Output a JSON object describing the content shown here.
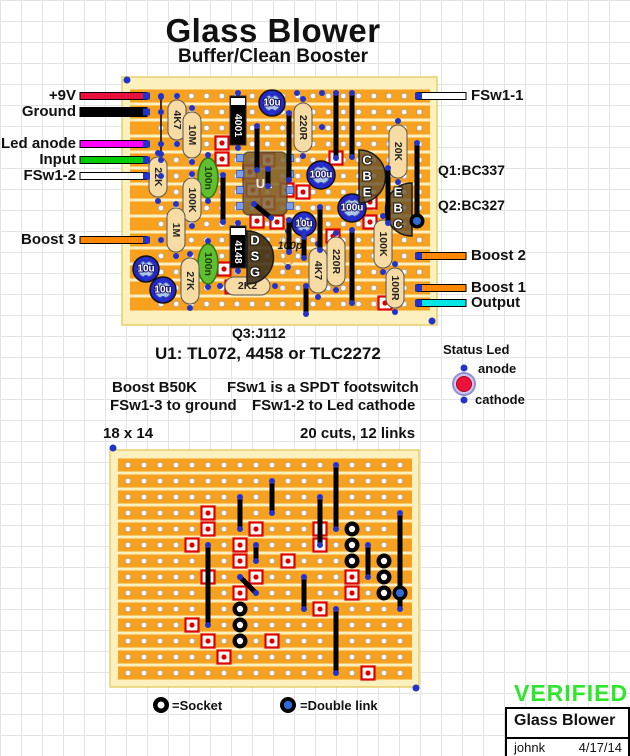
{
  "page": {
    "title": "Glass Blower",
    "subtitle": "Buffer/Clean Booster"
  },
  "annotations": {
    "q3": "Q3:J112",
    "u1": "U1: TL072, 4458 or TLC2272",
    "note_boost": "Boost B50K",
    "note_fsw": "FSw1 is a SPDT footswitch",
    "note_ground": "FSw1-3 to ground",
    "note_cathode": "FSw1-2 to Led cathode",
    "size": "18 x 14",
    "cuts": "20 cuts, 12 links"
  },
  "status_led": {
    "title": "Status Led",
    "anode": "anode",
    "cathode": "cathode",
    "body_color": "#C9C9EF",
    "ring_color": "#8F8FD0",
    "core_color": "#EE1139"
  },
  "legend": {
    "socket": "=Socket",
    "double_link": "=Double link"
  },
  "verified": {
    "text": "VERIFIED",
    "color": "#2FE62F",
    "box_title": "Glass Blower",
    "author": "johnk",
    "date": "4/17/14"
  },
  "colors": {
    "board_margin": "#FBF0BE",
    "board_edge": "#E8CE6B",
    "strip": "#F7A11E",
    "pad_blue": "#2233CC",
    "cut_red": "#DD0000",
    "resistor": "#F6DCA4",
    "cap_blue_outer": "#2626CC",
    "cap_blue_inner": "#AEC6E4",
    "film_green": "#5FBF30",
    "film_edge": "#2E7A12",
    "ic_fill": "rgba(125,98,50,0.85)",
    "trans_fill": "rgba(100,78,38,0.8)",
    "trans_dark_fill": "rgba(58,46,24,0.88)",
    "ic_pad": "#7E9FE8"
  },
  "main_board": {
    "rect": [
      122,
      77,
      315,
      248
    ],
    "strip_rect": [
      130,
      89.5,
      300,
      13
    ],
    "cols": 18,
    "rows": 14,
    "col0": 161,
    "row0": 96,
    "pitch_x": 15.2,
    "pitch_y": 16,
    "resistors_v": [
      {
        "label": "4K7",
        "x": 177,
        "y1": 100,
        "y2": 140
      },
      {
        "label": "10M",
        "x": 192,
        "y1": 112,
        "y2": 158
      },
      {
        "label": "22K",
        "x": 158,
        "y1": 157,
        "y2": 197
      },
      {
        "label": "100K",
        "x": 192,
        "y1": 178,
        "y2": 222
      },
      {
        "label": "1M",
        "x": 176,
        "y1": 208,
        "y2": 252
      },
      {
        "label": "27K",
        "x": 190,
        "y1": 258,
        "y2": 304
      },
      {
        "label": "220R",
        "x": 303,
        "y1": 103,
        "y2": 152
      },
      {
        "label": "20K",
        "x": 398,
        "y1": 125,
        "y2": 178
      },
      {
        "label": "4K7",
        "x": 318,
        "y1": 248,
        "y2": 293
      },
      {
        "label": "220R",
        "x": 336,
        "y1": 237,
        "y2": 286
      },
      {
        "label": "100K",
        "x": 383,
        "y1": 220,
        "y2": 268
      },
      {
        "label": "100R",
        "x": 395,
        "y1": 268,
        "y2": 308
      }
    ],
    "resistors_h": [
      {
        "label": "2K2",
        "x1": 225,
        "x2": 270,
        "y": 286
      }
    ],
    "film_caps": [
      {
        "label": "100n",
        "cx": 208,
        "cy": 178,
        "rx": 10,
        "ry": 20
      },
      {
        "label": "100n",
        "cx": 208,
        "cy": 264,
        "rx": 10,
        "ry": 20
      }
    ],
    "ceramic_caps": [
      {
        "label": "100p",
        "cx": 288,
        "cy": 249,
        "rx": 8,
        "ry": 16
      }
    ],
    "elec_caps": [
      {
        "label": "10u",
        "cx": 272,
        "cy": 103,
        "r": 13
      },
      {
        "label": "100u",
        "cx": 321,
        "cy": 175,
        "r": 14
      },
      {
        "label": "100u",
        "cx": 352,
        "cy": 208,
        "r": 14
      },
      {
        "label": "10u",
        "cx": 304,
        "cy": 224,
        "r": 12
      },
      {
        "label": "10u",
        "cx": 146,
        "cy": 269,
        "r": 13
      },
      {
        "label": "10u",
        "cx": 163,
        "cy": 290,
        "r": 13
      }
    ],
    "diodes": [
      {
        "label": "4001",
        "x": 238,
        "y1": 96,
        "y2": 145
      },
      {
        "label": "4148",
        "x": 238,
        "y1": 226,
        "y2": 268
      }
    ],
    "ic": {
      "label": "U1",
      "x": 243,
      "y": 152,
      "w": 44,
      "h": 63
    },
    "ic_pads": [
      [
        240,
        158
      ],
      [
        240,
        174
      ],
      [
        240,
        190
      ],
      [
        240,
        206
      ],
      [
        290,
        158
      ],
      [
        290,
        174
      ],
      [
        290,
        190
      ],
      [
        290,
        206
      ]
    ],
    "transistors": [
      {
        "letters": [
          "C",
          "B",
          "E"
        ],
        "flat_x": 359,
        "y1": 150,
        "y2": 203,
        "bulge": "right",
        "lx": 367,
        "ly": [
          160,
          176,
          192
        ],
        "dark": false
      },
      {
        "letters": [
          "E",
          "B",
          "C"
        ],
        "flat_x": 412,
        "y1": 183,
        "y2": 236,
        "bulge": "left",
        "lx": 398,
        "ly": [
          192,
          208,
          224
        ],
        "dark": false
      },
      {
        "letters": [
          "D",
          "S",
          "G"
        ],
        "flat_x": 247,
        "y1": 231,
        "y2": 284,
        "bulge": "right",
        "lx": 255,
        "ly": [
          240,
          256,
          272
        ],
        "dark": true
      }
    ],
    "links": [
      [
        257,
        126,
        170
      ],
      [
        289,
        113,
        180
      ],
      [
        336,
        93,
        158
      ],
      [
        352,
        93,
        157
      ],
      [
        223,
        175,
        222
      ],
      [
        289,
        220,
        252
      ],
      [
        304,
        237,
        258
      ],
      [
        320,
        207,
        250
      ],
      [
        352,
        230,
        303
      ],
      [
        388,
        168,
        223
      ],
      [
        417,
        143,
        222
      ],
      [
        306,
        286,
        314
      ],
      [
        268,
        169,
        186
      ]
    ],
    "thin_links": [
      [
        161,
        97,
        154
      ]
    ],
    "diag_links": [
      [
        254,
        204,
        271,
        218
      ]
    ],
    "sockets_px": [
      [
        222,
        143
      ],
      [
        222,
        159
      ],
      [
        250,
        172
      ],
      [
        268,
        160
      ],
      [
        253,
        190
      ],
      [
        268,
        203
      ],
      [
        287,
        190
      ],
      [
        303,
        192
      ],
      [
        257,
        221
      ],
      [
        277,
        222
      ],
      [
        336,
        158
      ],
      [
        333,
        236
      ],
      [
        370,
        202
      ],
      [
        370,
        222
      ],
      [
        224,
        269
      ],
      [
        232,
        287
      ],
      [
        385,
        303
      ]
    ],
    "double_rings": [
      [
        417,
        221
      ]
    ],
    "reg_dots": [
      [
        127,
        80
      ],
      [
        432,
        321
      ]
    ],
    "extra_pads": [
      [
        297,
        93
      ],
      [
        322,
        93
      ],
      [
        322,
        127
      ],
      [
        161,
        96
      ],
      [
        161,
        112
      ],
      [
        161,
        144
      ],
      [
        161,
        160
      ],
      [
        161,
        176
      ],
      [
        161,
        240
      ],
      [
        419,
        96
      ],
      [
        419,
        256
      ],
      [
        419,
        288
      ],
      [
        419,
        303
      ]
    ],
    "wires_left": [
      {
        "label": "+9V",
        "color": "#E8103C",
        "y": 96,
        "lw": 5
      },
      {
        "label": "Ground",
        "color": "#000000",
        "y": 112,
        "lw": 7
      },
      {
        "label": "Led anode",
        "color": "#FF00FF",
        "y": 144,
        "lw": 5
      },
      {
        "label": "Input",
        "color": "#00CC00",
        "y": 160,
        "lw": 5
      },
      {
        "label": "FSw1-2",
        "color": "#FFFFFF",
        "y": 176,
        "lw": 5
      },
      {
        "label": "Boost 3",
        "color": "#FF8800",
        "y": 240,
        "lw": 5
      }
    ],
    "wires_right": [
      {
        "label": "FSw1-1",
        "color": "#FFFFFF",
        "y": 96,
        "lw": 5
      },
      {
        "label": "Boost 2",
        "color": "#FF8800",
        "y": 256,
        "lw": 5
      },
      {
        "label": "Boost 1",
        "color": "#FF8800",
        "y": 288,
        "lw": 5
      },
      {
        "label": "Output",
        "color": "#00E5E5",
        "y": 303,
        "lw": 5
      }
    ],
    "side_texts": [
      {
        "label": "Q1:BC337",
        "x": 438,
        "y": 170
      },
      {
        "label": "Q2:BC327",
        "x": 438,
        "y": 205
      }
    ]
  },
  "build_board": {
    "rect": [
      110,
      450,
      309,
      237
    ],
    "strip_rect": [
      118,
      458.5,
      294,
      13
    ],
    "cols": 18,
    "rows": 14,
    "col0": 128,
    "row0": 465,
    "pitch_x": 16,
    "pitch_y": 16,
    "cuts": [
      [
        6,
        4
      ],
      [
        6,
        5
      ],
      [
        5,
        6
      ],
      [
        9,
        5
      ],
      [
        8,
        6
      ],
      [
        8,
        7
      ],
      [
        11,
        7
      ],
      [
        9,
        8
      ],
      [
        6,
        8
      ],
      [
        8,
        9
      ],
      [
        13,
        5
      ],
      [
        13,
        6
      ],
      [
        15,
        8
      ],
      [
        15,
        9
      ],
      [
        13,
        10
      ],
      [
        5,
        11
      ],
      [
        6,
        12
      ],
      [
        10,
        12
      ],
      [
        7,
        13
      ],
      [
        16,
        14
      ]
    ],
    "links": [
      [
        14,
        1,
        5
      ],
      [
        10,
        2,
        4
      ],
      [
        8,
        3,
        5
      ],
      [
        13,
        3,
        6
      ],
      [
        18,
        4,
        10
      ],
      [
        6,
        6,
        11
      ],
      [
        9,
        6,
        7
      ],
      [
        12,
        8,
        10
      ],
      [
        16,
        6,
        8
      ],
      [
        14,
        10,
        14
      ]
    ],
    "diag_links": [
      [
        8,
        8,
        9,
        9
      ]
    ],
    "sockets": [
      [
        15,
        5
      ],
      [
        15,
        6
      ],
      [
        15,
        7
      ],
      [
        17,
        7
      ],
      [
        17,
        8
      ],
      [
        17,
        9
      ],
      [
        8,
        10
      ],
      [
        8,
        11
      ],
      [
        8,
        12
      ]
    ],
    "double_links": [
      [
        18,
        9
      ]
    ],
    "reg_dots": [
      [
        113,
        448
      ],
      [
        416,
        688
      ]
    ]
  }
}
